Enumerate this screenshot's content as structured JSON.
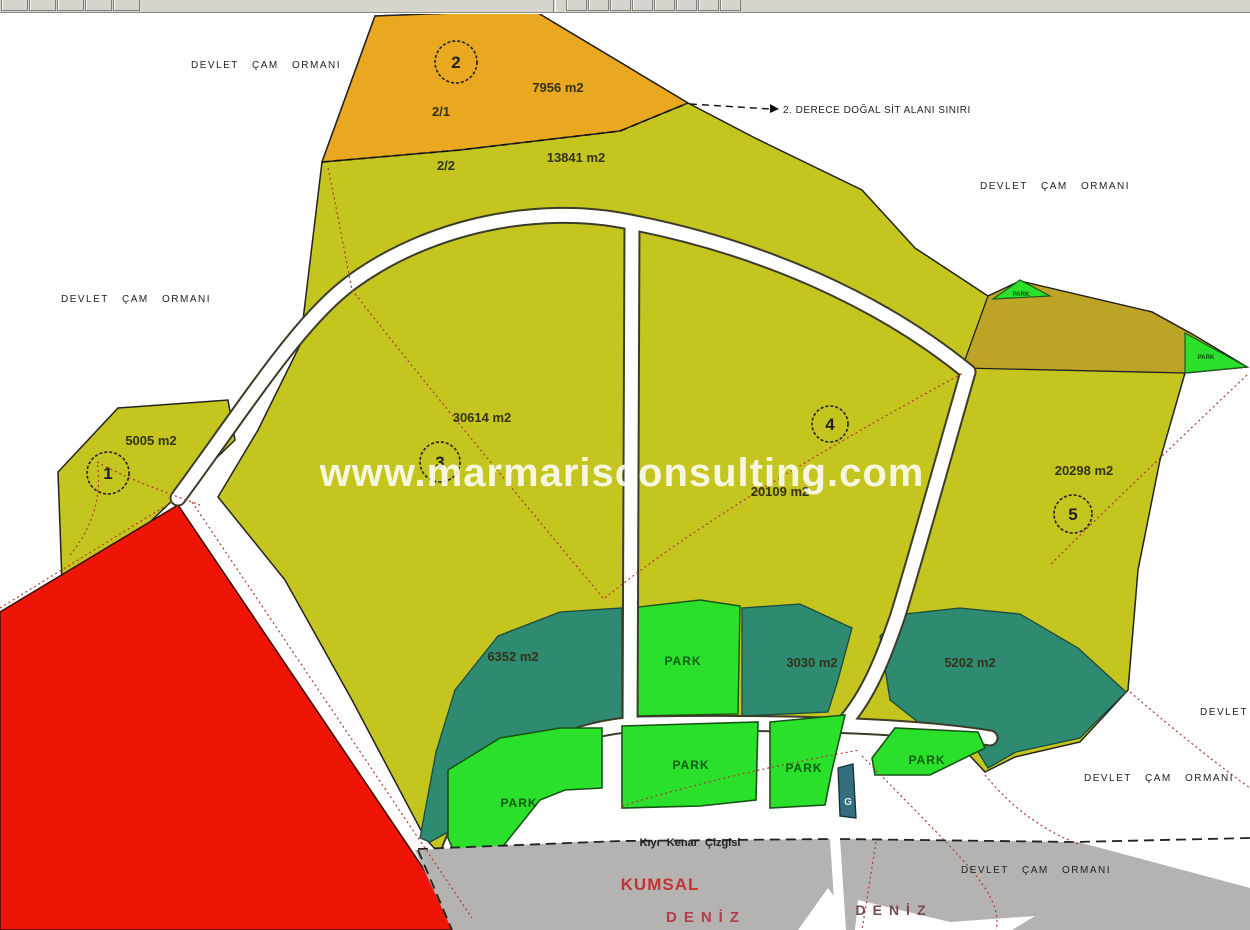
{
  "watermark": "www.marmarisconsulting.com",
  "boundary": {
    "sit_label": "2. DERECE DOĞAL SİT ALANI SINIRI"
  },
  "forest_label": "DEVLET ÇAM ORMANI",
  "forest_partial": "DEVLET",
  "parcels": {
    "p1": {
      "no": "1",
      "area": "5005 m2"
    },
    "p2": {
      "no": "2",
      "area": "7956 m2",
      "sub_a": "2/1",
      "sub_b": "2/2",
      "area_b": "13841 m2"
    },
    "p3": {
      "no": "3",
      "area": "30614 m2"
    },
    "p4": {
      "no": "4",
      "area": "20109 m2"
    },
    "p5": {
      "no": "5",
      "area": "20298 m2"
    }
  },
  "zones": {
    "z1": "6352 m2",
    "z2": "3030 m2",
    "z3": "5202 m2"
  },
  "park_label": "PARK",
  "g_label": "G",
  "coast": {
    "kiyi_line": "Kıyı Kenar Çizgisi",
    "kumsal": "KUMSAL",
    "deniz": "DENİZ"
  },
  "colors": {
    "parcel_yellow": "#c5c51f",
    "parcel_orange": "#e9a81f",
    "band_olive": "#bda427",
    "zone_teal": "#2f8a72",
    "park_green": "#2be02b",
    "g_teal": "#336f80",
    "red_zone": "#ee1506",
    "beach_grey": "#b5b3b1"
  }
}
